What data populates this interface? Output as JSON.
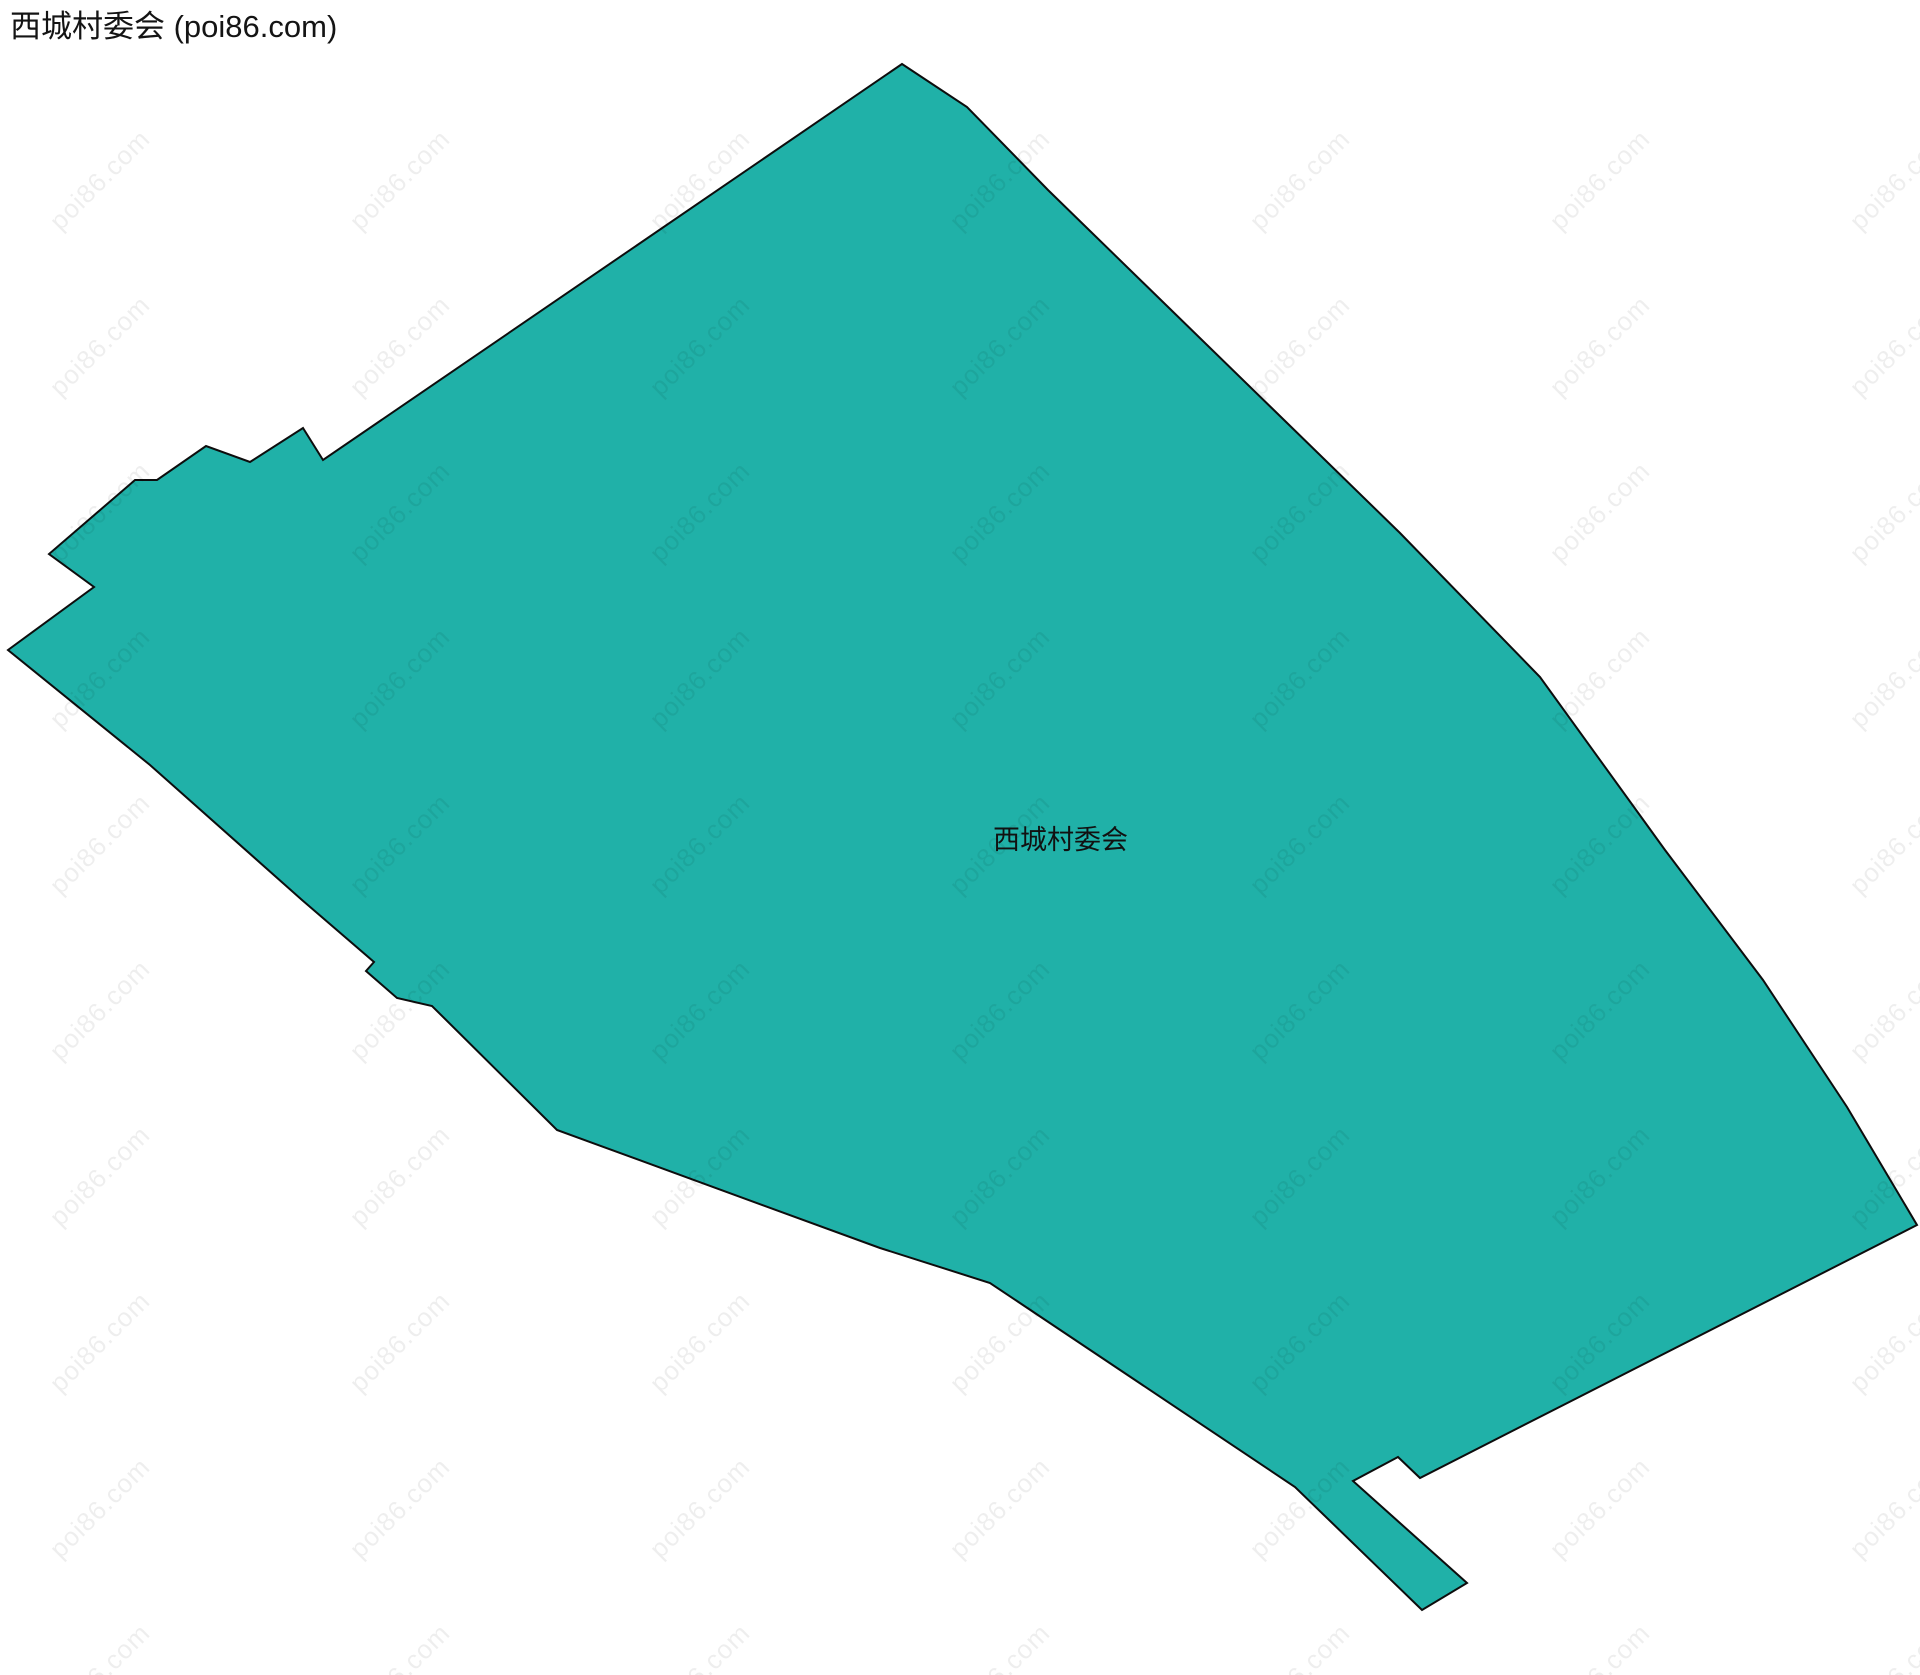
{
  "page": {
    "title": "西城村委会 (poi86.com)"
  },
  "map": {
    "region_label": "西城村委会",
    "polygon": {
      "name": "西城村委会",
      "fill": "#20B1A8",
      "stroke": "#0d0d0d",
      "points": "902,64 967,107 1048,190 1400,533 1540,677 1665,850 1763,980 1847,1107 1917,1225 1420,1478 1398,1457 1353,1481 1467,1583 1422,1610 1295,1487 990,1283 880,1248 557,1130 432,1006 397,998 366,971 374,962 302,900 150,765 8,650 94,587 49,554 135,480 157,480 206,446 250,462 303,428 323,460"
    }
  },
  "watermark": {
    "text": "poi86.com"
  }
}
